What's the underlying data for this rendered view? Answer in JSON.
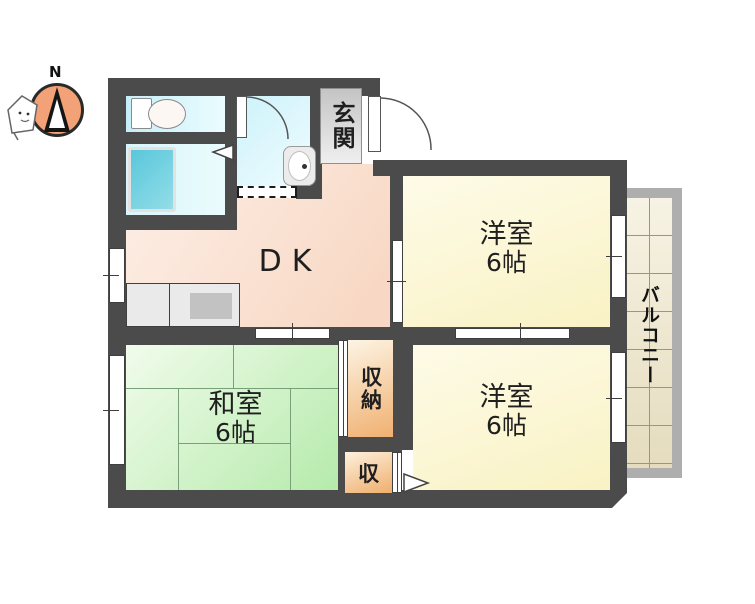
{
  "compass": {
    "north_label": "N"
  },
  "rooms": {
    "entrance": {
      "label": "玄関"
    },
    "dining_kitchen": {
      "label": "DK"
    },
    "western_room_top": {
      "name": "洋室",
      "size": "6帖"
    },
    "western_room_bottom": {
      "name": "洋室",
      "size": "6帖"
    },
    "japanese_room": {
      "name": "和室",
      "size": "6帖"
    },
    "storage_large": {
      "label": "収納"
    },
    "storage_small": {
      "label": "収"
    },
    "balcony": {
      "label": "バルコニー"
    }
  },
  "colors": {
    "wall": "#4b4b4b",
    "dk_floor": "#f9dcc9",
    "western_room_floor": "#faf3c9",
    "japanese_room_floor": "#b9e9ae",
    "sanitary_floor": "#d3f4fa",
    "bathtub": "#63cbdd",
    "storage": "#f2b577",
    "balcony_tile": "#ece3c7",
    "entrance_floor": "#d6d6d6",
    "compass_fill": "#f2a276"
  }
}
